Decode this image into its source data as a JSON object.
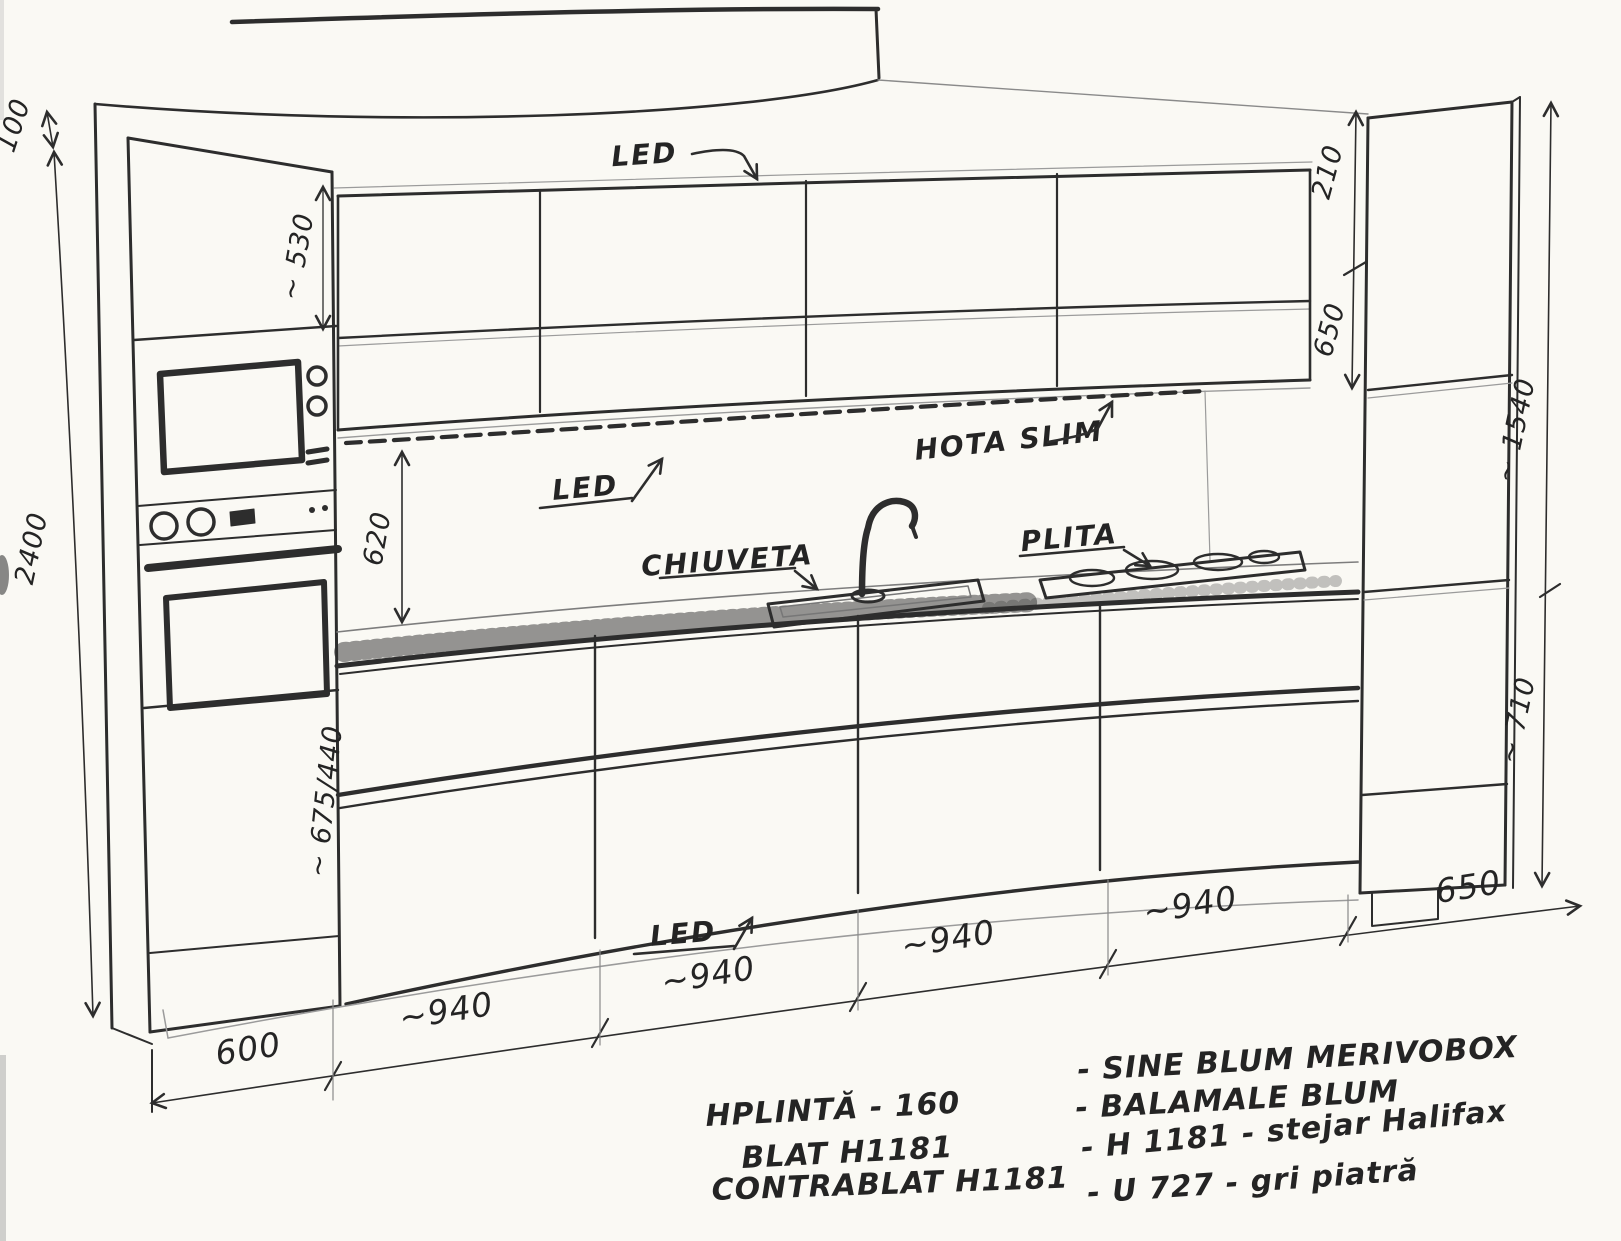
{
  "labels": {
    "led": "LED",
    "hood": "HOTA SLIM",
    "sink": "CHIUVETA",
    "hob": "PLITA"
  },
  "dims": {
    "ceiling_gap": "100",
    "total_height": "2400",
    "left_upper_door": "~ 530",
    "splashback_height": "620",
    "right_gap_top": "210",
    "upper_cabinets_height": "650",
    "right_tall_upper": "~ 1540",
    "right_tall_lower": "~ 710",
    "left_drawer_heights": "~ 675/440",
    "widths": [
      "600",
      "~940",
      "~940",
      "~940",
      "~940",
      "650"
    ]
  },
  "notes_left": [
    "HPLINTĂ - 160",
    "BLAT H1181",
    "CONTRABLAT H1181"
  ],
  "notes_right": [
    "- SINE BLUM MERIVOBOX",
    "- BALAMALE  BLUM",
    "- H 1181 - stejar Halifax",
    "- U 727 - gri piatră"
  ],
  "colors": {
    "ink": "#2d2d2d",
    "pencil": "#9b9b9b",
    "paper": "#faf9f4"
  }
}
